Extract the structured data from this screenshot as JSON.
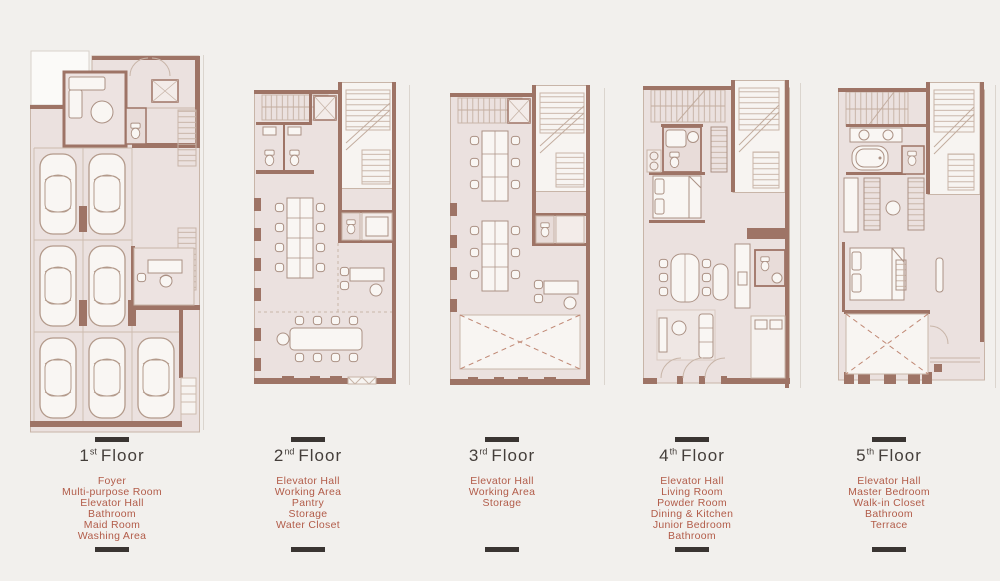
{
  "page": {
    "background": "#f2f0ed"
  },
  "palette": {
    "wall_brown": "#9e7466",
    "room_fill": "#ebe1df",
    "stair_hall_fill": "#f7f4f1",
    "furniture_stroke": "#ab9184",
    "room_list_text": "#b25c49",
    "title_text": "#443e3a",
    "divider_bar": "#3a3532",
    "void_dash": "#c08874"
  },
  "floors": [
    {
      "number": "1",
      "ordinal": "st",
      "word": "Floor",
      "rooms": [
        "Foyer",
        "Multi-purpose Room",
        "Elevator Hall",
        "Bathroom",
        "Maid Room",
        "Washing Area"
      ]
    },
    {
      "number": "2",
      "ordinal": "nd",
      "word": "Floor",
      "rooms": [
        "Elevator Hall",
        "Working Area",
        "Pantry",
        "Storage",
        "Water Closet"
      ]
    },
    {
      "number": "3",
      "ordinal": "rd",
      "word": "Floor",
      "rooms": [
        "Elevator Hall",
        "Working Area",
        "Storage"
      ]
    },
    {
      "number": "4",
      "ordinal": "th",
      "word": "Floor",
      "rooms": [
        "Elevator Hall",
        "Living Room",
        "Powder Room",
        "Dining & Kitchen",
        "Junior Bedroom",
        "Bathroom"
      ]
    },
    {
      "number": "5",
      "ordinal": "th",
      "word": "Floor",
      "rooms": [
        "Elevator Hall",
        "Master Bedroom",
        "Walk-in Closet",
        "Bathroom",
        "Terrace"
      ]
    }
  ]
}
